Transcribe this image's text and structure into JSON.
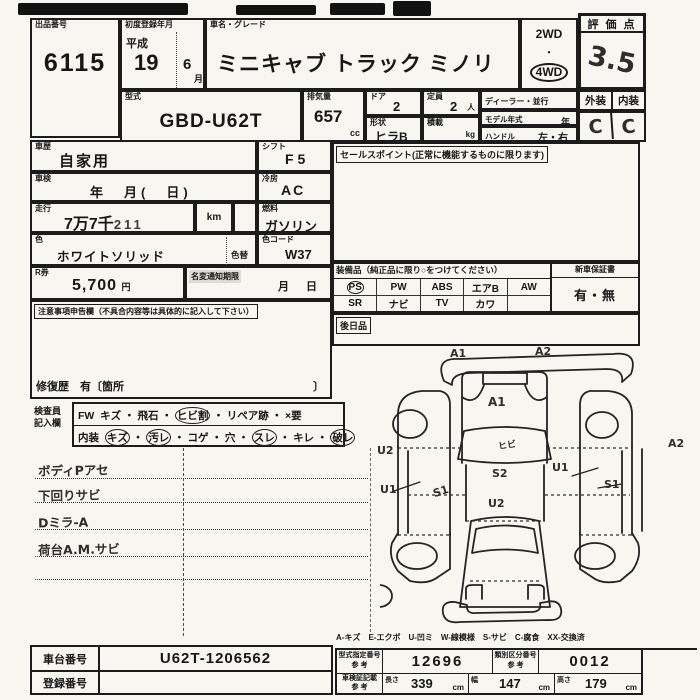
{
  "sheet": {
    "auction_no": {
      "label": "出品番号",
      "value": "6115"
    },
    "first_reg": {
      "label": "初度登録年月",
      "era": "平成",
      "year": "19",
      "month": "6",
      "month_unit": "月"
    },
    "car_name": {
      "label": "車名・グレード",
      "value": "ミニキャブ トラック ミノリ"
    },
    "drive": {
      "opt1": "2WD",
      "dot": "・",
      "opt2": "4WD"
    },
    "score": {
      "label": "評 価 点",
      "value": "3.5"
    },
    "grades": {
      "ext_label": "外装",
      "int_label": "内装",
      "ext_value": "C",
      "int_value": "C"
    },
    "model_code": {
      "label": "型式",
      "value": "GBD-U62T"
    },
    "displacement": {
      "label": "排気量",
      "value": "657",
      "unit": "cc"
    },
    "doors": {
      "label": "ドア",
      "value": "2"
    },
    "capacity": {
      "label": "定員",
      "value": "2",
      "unit": "人"
    },
    "dealer": {
      "label": "ディーラー・並行"
    },
    "model_year": {
      "label": "モデル年式",
      "unit": "年"
    },
    "handle": {
      "label": "ハンドル",
      "value": "左・右"
    },
    "shape": {
      "label": "形状",
      "value": "ヒラB"
    },
    "load": {
      "label": "積載",
      "unit": "kg"
    },
    "history": {
      "label": "車歴",
      "value": "自家用"
    },
    "shift": {
      "label": "シフト",
      "value": "F 5"
    },
    "sales_point": {
      "label": "セールスポイント(正常に機能するものに限ります)"
    },
    "inspection": {
      "label": "車検",
      "value": "年　月(　日)"
    },
    "aircon": {
      "label": "冷房",
      "value": "AC"
    },
    "mileage": {
      "label": "走行",
      "man": "7万7千",
      "digits": "211",
      "unit": "km"
    },
    "fuel": {
      "label": "燃料",
      "value": "ガソリン"
    },
    "color": {
      "label": "色",
      "value": "ホワイトソリッド",
      "change_label": "色替"
    },
    "color_code": {
      "label": "色コード",
      "value": "W37"
    },
    "r_ticket": {
      "label": "R券",
      "value": "5,700",
      "unit": "円"
    },
    "name_change": {
      "label": "名変通知期限",
      "value": "月　日"
    },
    "equipment": {
      "label": "装備品（純正品に限り○をつけてください）",
      "warranty_label": "新車保証書",
      "warranty_value": "有・無",
      "row1": [
        "PS",
        "PW",
        "ABS",
        "エアB",
        "AW"
      ],
      "row2": [
        "SR",
        "ナビ",
        "TV",
        "カワ",
        ""
      ]
    },
    "later_goods": {
      "label": "後日品"
    },
    "caution": {
      "label": "注意事項申告欄（不具合内容等は具体的に記入して下さい）",
      "repair_label": "修復歴　有〔箇所",
      "repair_close": "〕"
    },
    "inspector": {
      "label_line1": "検査員",
      "label_line2": "記入欄",
      "sep": "・",
      "fw": {
        "prefix": "FW",
        "items": [
          "キズ",
          "飛石",
          "ヒビ割",
          "リペア跡",
          "×要"
        ]
      },
      "interior": {
        "prefix": "内装",
        "items": [
          "キズ",
          "汚レ",
          "コゲ",
          "穴",
          "スレ",
          "キレ",
          "破レ"
        ]
      }
    },
    "notes": [
      "ボディPアセ",
      "下回りサビ",
      "Dミラ-A",
      "荷台A.M.サビ"
    ],
    "diagram": {
      "marks": [
        {
          "text": "A1"
        },
        {
          "text": "A2"
        },
        {
          "text": "A1"
        },
        {
          "text": "ヒビ"
        },
        {
          "text": "U2"
        },
        {
          "text": "U1"
        },
        {
          "text": "S1"
        },
        {
          "text": "S2"
        },
        {
          "text": "U1"
        },
        {
          "text": "S1"
        },
        {
          "text": "A2"
        },
        {
          "text": "U2"
        }
      ],
      "legend": "A-キズ　E-エクボ　U-凹ミ　W-線模様　S-サビ　C-腐食　XX-交換済"
    },
    "chassis": {
      "label": "車台番号",
      "value": "U62T-1206562"
    },
    "registration": {
      "label": "登録番号",
      "value": ""
    },
    "type_cert": {
      "label1": "型式指定番号",
      "label2": "参 考",
      "value": "12696"
    },
    "class_no": {
      "label1": "類別区分番号",
      "label2": "参 考",
      "value": "0012"
    },
    "dims": {
      "label1": "車検証記載",
      "label2": "参 考",
      "length_label": "長さ",
      "length": "339",
      "width_label": "幅",
      "width": "147",
      "height_label": "高さ",
      "height": "179",
      "unit": "cm"
    }
  }
}
